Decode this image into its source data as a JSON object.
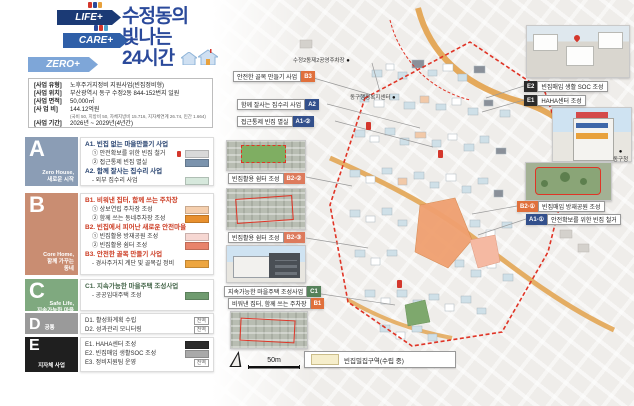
{
  "header": {
    "arrows": [
      {
        "label": "LIFE+",
        "color": "#1b3a75"
      },
      {
        "label": "CARE+",
        "color": "#2f5fa8"
      },
      {
        "label": "ZERO+",
        "color": "#7ea6d8"
      }
    ],
    "title_lines": "수정동의\n빛나는\n24시간",
    "title_color": "#2b4a9b"
  },
  "info": {
    "rows": [
      {
        "label": "[사업 유형]",
        "value": "노후주거지정비 지원사업(빈집정비형)"
      },
      {
        "label": "[사업 위치]",
        "value": "부산광역시 동구 수정2동 844-152번지 일원"
      },
      {
        "label": "[사업 면적]",
        "value": "50,000㎡"
      },
      {
        "label": "[사 업 비]",
        "value": "144.12억원",
        "note": "(국비 50, 지방비 50, 자체지방비 15.716, 지자체연계 26.74, 민간 1.664)"
      },
      {
        "label": "[사업 기간]",
        "value": "2026년 ~ 2029년(4년간)"
      }
    ]
  },
  "sections": [
    {
      "letter": "A",
      "subtitle": "Zero House,\n새로운 시작",
      "tile_color": "#8b9db5",
      "groups": [
        {
          "title": "A1. 빈집 없는 마을만들기 사업",
          "items": [
            {
              "text": "① 안전확보를 위한 빈집 철거",
              "swatch": "#d9d9d9"
            },
            {
              "text": "② 접근통제 빈집 멸실",
              "swatch": "#7b93ad"
            }
          ]
        },
        {
          "title": "A2. 함께 잘사는 집수리 사업",
          "items": [
            {
              "text": "- 외부 집수리 사업",
              "swatch": "#d6e8dc"
            }
          ]
        }
      ]
    },
    {
      "letter": "B",
      "subtitle": "Core Home,\n함께 가꾸는\n동네",
      "tile_color": "#c98d72",
      "groups": [
        {
          "title": "B1. 비워낸 집터, 함께 쓰는 주차장",
          "items": [
            {
              "text": "① 상보연립 주차장 조성",
              "swatch": "#f5cfae"
            },
            {
              "text": "② 함께 쓰는 동네주차장 조성",
              "swatch": "#e8902e"
            }
          ]
        },
        {
          "title": "B2. 빈집에서 피어난 새로운 안전마을",
          "items": [
            {
              "text": "① 빈집활용 방재공원 조성",
              "swatch": "#f6d7d2"
            },
            {
              "text": "② 빈집활용 쉼터 조성",
              "swatch": "#e8836b"
            }
          ]
        },
        {
          "title": "B3. 안전한 골목 만들기 사업",
          "items": [
            {
              "text": "- 경사주거지 계단 및 골목길 정비",
              "swatch": "#eda53f"
            }
          ]
        }
      ]
    },
    {
      "letter": "C",
      "subtitle": "Safe Life,\n지속가능한 마을",
      "tile_color": "#7fa97f",
      "groups": [
        {
          "title": "C1. 지속가능한 마을주택 조성사업",
          "items": [
            {
              "text": "- 공공임대주택 조성",
              "swatch": "#6f9b6f"
            }
          ]
        }
      ]
    },
    {
      "letter": "D",
      "subtitle": "공통",
      "tile_color": "#9a9a9a",
      "groups": [
        {
          "title": "",
          "items": [
            {
              "text": "D1. 활성화계획 수립",
              "badge": "전역"
            },
            {
              "text": "D2. 성과관리 모니터링",
              "badge": "전역"
            }
          ]
        }
      ]
    },
    {
      "letter": "E",
      "subtitle": "지자체 사업",
      "tile_color": "#1f1f1f",
      "groups": [
        {
          "title": "",
          "items": [
            {
              "text": "E1. HAHA센터 조성",
              "swatch": "#2b2b2b"
            },
            {
              "text": "E2. 빈집매입 생활SOC 조성",
              "swatch": "#a9a9a9"
            },
            {
              "text": "E3. 정비지원팀 운영",
              "badge": "전역"
            }
          ]
        }
      ]
    }
  ],
  "map": {
    "callouts": {
      "b3": {
        "text": "안전한 골목 만들기 사업",
        "badge": "B3"
      },
      "a2": {
        "text": "함께 잘사는 집수리 사업",
        "badge": "A2"
      },
      "a12": {
        "text": "접근통제 빈집 멸실",
        "badge": "A1-②"
      },
      "b22": {
        "text": "빈집활용 쉼터 조성",
        "badge": "B2-②"
      },
      "b23": {
        "text": "빈집활용 쉼터 조성",
        "badge": "B2-③"
      },
      "c1": {
        "text": "지속가능한 마을주택 조성사업",
        "badge": "C1"
      },
      "b1": {
        "text": "비워낸 집터, 함께 쓰는 주차장",
        "badge": "B1"
      },
      "b21": {
        "badge": "B2-①",
        "text": "빈집매입 방재공원 조성"
      },
      "a11": {
        "badge": "A1-①",
        "text": "안전확보를 위한 빈집 철거"
      },
      "e2": {
        "badge": "E2",
        "text": "빈집매입 생활 SOC 조성"
      },
      "e1": {
        "badge": "E1",
        "text": "HAHA센터 조성"
      }
    },
    "landmarks": {
      "parking": "수정2동제2공영주차장",
      "welfare_center": "동구행정복지센터",
      "gu_office": "동구청"
    },
    "scale_label": "50m",
    "legend_label": "빈집밀집구역(수립 중)",
    "boundary_color": "#e03426",
    "road_color": "#e2a14b"
  }
}
